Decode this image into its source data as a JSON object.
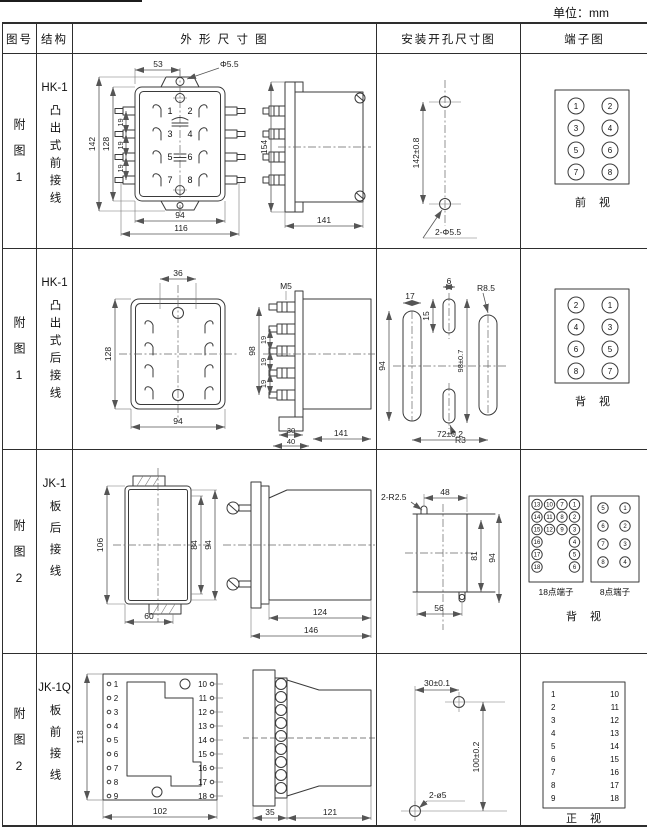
{
  "unit_label": "单位：mm",
  "header": {
    "figure": "图号",
    "structure": "结构",
    "outline": "外 形 尺 寸 图",
    "mounting": "安装开孔尺寸图",
    "terminal": "端子图"
  },
  "rows": [
    {
      "figure": "附图1",
      "model": "HK-1",
      "structure": "凸出式前接线",
      "outline": {
        "front": {
          "w_top": "53",
          "hole": "Φ5.5",
          "h_total": "142",
          "h_body": "128",
          "pitch1": "19",
          "pitch2": "19",
          "pitch3": "19",
          "w_body": "94",
          "w_total": "116",
          "n1": "1",
          "n2": "2",
          "n3": "3",
          "n4": "4",
          "n5": "5",
          "n6": "6",
          "n7": "7",
          "n8": "8"
        },
        "side": {
          "h": "154",
          "d": "141"
        }
      },
      "mounting": {
        "v": "142±0.8",
        "holes": "2-Φ5.5"
      },
      "terminal": {
        "caption": "前 视",
        "n": [
          "1",
          "2",
          "3",
          "4",
          "5",
          "6",
          "7",
          "8"
        ]
      }
    },
    {
      "figure": "附图1",
      "model": "HK-1",
      "structure": "凸出式后接线",
      "outline": {
        "front": {
          "w_top": "36",
          "h_body": "128",
          "w_body": "94"
        },
        "side": {
          "thread": "M5",
          "h": "98",
          "pitch1": "19",
          "pitch2": "19",
          "pitch3": "19",
          "d30": "30",
          "d40": "40",
          "d": "141"
        }
      },
      "mounting": {
        "d17": "17",
        "d6": "6",
        "d15": "15",
        "d94": "94",
        "v": "98±0.7",
        "r1": "R8.5",
        "r2": "R3",
        "h": "72±0.2"
      },
      "terminal": {
        "caption": "背 视",
        "n": [
          "2",
          "1",
          "4",
          "3",
          "6",
          "5",
          "8",
          "7"
        ]
      }
    },
    {
      "figure": "附图2",
      "model": "JK-1",
      "structure": "板后接线",
      "outline": {
        "front": {
          "h_total": "106",
          "h1": "84",
          "h2": "94",
          "w_bottom": "60"
        },
        "side": {
          "d1": "124",
          "d2": "146"
        }
      },
      "mounting": {
        "r": "2-R2.5",
        "d48": "48",
        "d81": "81",
        "d94": "94",
        "d56": "56"
      },
      "terminal": {
        "label18": "18点端子",
        "label8": "8点端子",
        "caption": "背 视",
        "t18": [
          [
            "13",
            "10",
            "7",
            "1"
          ],
          [
            "14",
            "11",
            "8",
            "2"
          ],
          [
            "15",
            "12",
            "9",
            "3"
          ],
          [
            "16",
            "4"
          ],
          [
            "17",
            "5"
          ],
          [
            "18",
            "6"
          ]
        ],
        "t8": [
          [
            "5",
            "1"
          ],
          [
            "6",
            "2"
          ],
          [
            "7",
            "3"
          ],
          [
            "8",
            "4"
          ]
        ]
      }
    },
    {
      "figure": "附图2",
      "model": "JK-1Q",
      "structure": "板前接线",
      "outline": {
        "front": {
          "h": "118",
          "w": "102",
          "left": [
            "1",
            "2",
            "3",
            "4",
            "5",
            "6",
            "7",
            "8",
            "9"
          ],
          "right": [
            "10",
            "11",
            "12",
            "13",
            "14",
            "15",
            "16",
            "17",
            "18"
          ]
        },
        "side": {
          "d35": "35",
          "d121": "121"
        }
      },
      "mounting": {
        "dh": "30±0.1",
        "dv": "100±0.2",
        "holes": "2-ø5"
      },
      "terminal": {
        "caption": "正 视",
        "left": [
          "1",
          "2",
          "3",
          "4",
          "5",
          "6",
          "7",
          "8",
          "9"
        ],
        "right": [
          "10",
          "11",
          "12",
          "13",
          "14",
          "15",
          "16",
          "17",
          "18"
        ]
      }
    }
  ]
}
